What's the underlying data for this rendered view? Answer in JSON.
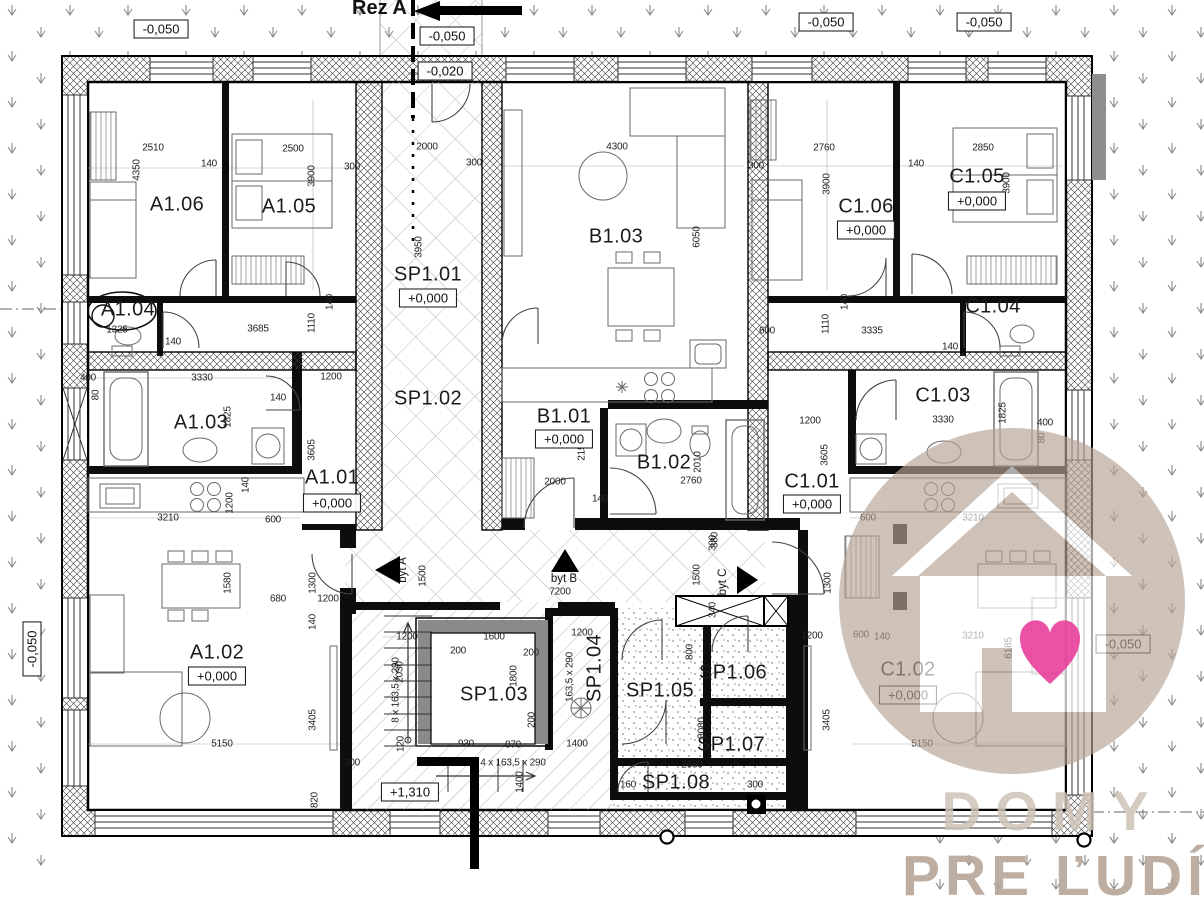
{
  "section_marker": {
    "label": "Rez A"
  },
  "apartments": [
    {
      "label": "byt A",
      "x": 403,
      "y": 570,
      "r": 1
    },
    {
      "label": "byt B",
      "x": 564,
      "y": 579,
      "r": 0
    },
    {
      "label": "byt C",
      "x": 723,
      "y": 582,
      "r": 1
    }
  ],
  "rooms": [
    {
      "label": "A1.06",
      "x": 177,
      "y": 205
    },
    {
      "label": "A1.05",
      "x": 289,
      "y": 207
    },
    {
      "label": "A1.04",
      "x": 128,
      "y": 310
    },
    {
      "label": "A1.03",
      "x": 201,
      "y": 423
    },
    {
      "label": "A1.01",
      "x": 332,
      "y": 478,
      "elev": "+0,000",
      "ey": 503
    },
    {
      "label": "A1.02",
      "x": 217,
      "y": 653,
      "elev": "+0,000",
      "ey": 676
    },
    {
      "label": "SP1.01",
      "x": 428,
      "y": 275,
      "elev": "+0,000",
      "ey": 298
    },
    {
      "label": "SP1.02",
      "x": 428,
      "y": 399
    },
    {
      "label": "B1.03",
      "x": 616,
      "y": 237
    },
    {
      "label": "B1.01",
      "x": 564,
      "y": 417,
      "elev": "+0,000",
      "ey": 439
    },
    {
      "label": "B1.02",
      "x": 664,
      "y": 463
    },
    {
      "label": "C1.06",
      "x": 866,
      "y": 207,
      "elev": "+0,000",
      "ey": 230
    },
    {
      "label": "C1.05",
      "x": 977,
      "y": 177,
      "elev": "+0,000",
      "ey": 201
    },
    {
      "label": "C1.04",
      "x": 993,
      "y": 307
    },
    {
      "label": "C1.03",
      "x": 943,
      "y": 396
    },
    {
      "label": "C1.01",
      "x": 812,
      "y": 482,
      "elev": "+0,000",
      "ey": 504
    },
    {
      "label": "C1.02",
      "x": 908,
      "y": 670,
      "elev": "+0,000",
      "ey": 695
    },
    {
      "label": "SP1.03",
      "x": 494,
      "y": 695
    },
    {
      "label": "SP1.04",
      "x": 595,
      "y": 668,
      "r": 1
    },
    {
      "label": "SP1.05",
      "x": 660,
      "y": 691
    },
    {
      "label": "SP1.06",
      "x": 733,
      "y": 673
    },
    {
      "label": "SP1.07",
      "x": 731,
      "y": 745
    },
    {
      "label": "SP1.08",
      "x": 676,
      "y": 783
    }
  ],
  "elevation_markers": [
    {
      "t": "-0,050",
      "x": 161,
      "y": 29
    },
    {
      "t": "-0,050",
      "x": 447,
      "y": 36
    },
    {
      "t": "-0,020",
      "x": 445,
      "y": 71
    },
    {
      "t": "-0,050",
      "x": 826,
      "y": 22
    },
    {
      "t": "-0,050",
      "x": 984,
      "y": 22
    },
    {
      "t": "-0,050",
      "x": 1123,
      "y": 644
    },
    {
      "t": "-0,050",
      "x": 32,
      "y": 649,
      "r": 1
    },
    {
      "t": "+1,310",
      "x": 410,
      "y": 792
    }
  ],
  "dimensions": [
    {
      "t": "2510",
      "x": 153,
      "y": 148
    },
    {
      "t": "4350",
      "x": 137,
      "y": 170,
      "r": 1
    },
    {
      "t": "140",
      "x": 209,
      "y": 164
    },
    {
      "t": "2500",
      "x": 293,
      "y": 149
    },
    {
      "t": "3900",
      "x": 312,
      "y": 176,
      "r": 1
    },
    {
      "t": "300",
      "x": 352,
      "y": 167
    },
    {
      "t": "2000",
      "x": 427,
      "y": 147
    },
    {
      "t": "300",
      "x": 474,
      "y": 163
    },
    {
      "t": "3950",
      "x": 419,
      "y": 247,
      "r": 1
    },
    {
      "t": "4300",
      "x": 617,
      "y": 147
    },
    {
      "t": "6050",
      "x": 697,
      "y": 237,
      "r": 1
    },
    {
      "t": "300",
      "x": 756,
      "y": 166
    },
    {
      "t": "2760",
      "x": 824,
      "y": 148
    },
    {
      "t": "3900",
      "x": 827,
      "y": 184,
      "r": 1
    },
    {
      "t": "140",
      "x": 916,
      "y": 164
    },
    {
      "t": "2850",
      "x": 983,
      "y": 148
    },
    {
      "t": "3900",
      "x": 1007,
      "y": 183,
      "r": 1
    },
    {
      "t": "1325",
      "x": 117,
      "y": 330
    },
    {
      "t": "140",
      "x": 173,
      "y": 342
    },
    {
      "t": "3685",
      "x": 258,
      "y": 329
    },
    {
      "t": "1110",
      "x": 312,
      "y": 323,
      "r": 1
    },
    {
      "t": "140",
      "x": 330,
      "y": 302,
      "r": 1
    },
    {
      "t": "400",
      "x": 88,
      "y": 378
    },
    {
      "t": "80",
      "x": 96,
      "y": 395,
      "r": 1
    },
    {
      "t": "3330",
      "x": 202,
      "y": 378
    },
    {
      "t": "1200",
      "x": 331,
      "y": 377
    },
    {
      "t": "1825",
      "x": 228,
      "y": 417,
      "r": 1
    },
    {
      "t": "140",
      "x": 278,
      "y": 398
    },
    {
      "t": "3605",
      "x": 312,
      "y": 450,
      "r": 1
    },
    {
      "t": "1200",
      "x": 230,
      "y": 503,
      "r": 1
    },
    {
      "t": "140",
      "x": 246,
      "y": 485,
      "r": 1
    },
    {
      "t": "3210",
      "x": 168,
      "y": 518
    },
    {
      "t": "600",
      "x": 273,
      "y": 520
    },
    {
      "t": "1580",
      "x": 228,
      "y": 583,
      "r": 1
    },
    {
      "t": "680",
      "x": 278,
      "y": 599
    },
    {
      "t": "1300",
      "x": 313,
      "y": 583,
      "r": 1
    },
    {
      "t": "1200",
      "x": 328,
      "y": 599
    },
    {
      "t": "140",
      "x": 313,
      "y": 622,
      "r": 1
    },
    {
      "t": "3405",
      "x": 313,
      "y": 720,
      "r": 1
    },
    {
      "t": "5150",
      "x": 222,
      "y": 744
    },
    {
      "t": "300",
      "x": 352,
      "y": 763
    },
    {
      "t": "820",
      "x": 315,
      "y": 800,
      "r": 1
    },
    {
      "t": "2150",
      "x": 582,
      "y": 450,
      "r": 1
    },
    {
      "t": "2000",
      "x": 555,
      "y": 482
    },
    {
      "t": "140",
      "x": 600,
      "y": 499
    },
    {
      "t": "2760",
      "x": 691,
      "y": 481
    },
    {
      "t": "2010",
      "x": 698,
      "y": 462,
      "r": 1
    },
    {
      "t": "1200",
      "x": 810,
      "y": 421
    },
    {
      "t": "380",
      "x": 715,
      "y": 540,
      "r": 1
    },
    {
      "t": "1500",
      "x": 697,
      "y": 575,
      "r": 1
    },
    {
      "t": "300",
      "x": 713,
      "y": 543,
      "r": 1
    },
    {
      "t": "7200",
      "x": 560,
      "y": 592
    },
    {
      "t": "1500",
      "x": 423,
      "y": 576,
      "r": 1
    },
    {
      "t": "340",
      "x": 713,
      "y": 610,
      "r": 1
    },
    {
      "t": "600",
      "x": 767,
      "y": 331
    },
    {
      "t": "3335",
      "x": 872,
      "y": 331
    },
    {
      "t": "1110",
      "x": 826,
      "y": 324,
      "r": 1
    },
    {
      "t": "140",
      "x": 845,
      "y": 302,
      "r": 1
    },
    {
      "t": "140",
      "x": 950,
      "y": 347
    },
    {
      "t": "3605",
      "x": 825,
      "y": 455,
      "r": 1
    },
    {
      "t": "3330",
      "x": 943,
      "y": 420
    },
    {
      "t": "1825",
      "x": 1003,
      "y": 413,
      "r": 1
    },
    {
      "t": "400",
      "x": 1045,
      "y": 423
    },
    {
      "t": "80",
      "x": 1042,
      "y": 438,
      "r": 1
    },
    {
      "t": "600",
      "x": 868,
      "y": 518
    },
    {
      "t": "3210",
      "x": 973,
      "y": 518
    },
    {
      "t": "1200",
      "x": 812,
      "y": 636
    },
    {
      "t": "600",
      "x": 861,
      "y": 635
    },
    {
      "t": "140",
      "x": 882,
      "y": 637
    },
    {
      "t": "3210",
      "x": 973,
      "y": 636
    },
    {
      "t": "6185",
      "x": 1009,
      "y": 648,
      "r": 1
    },
    {
      "t": "1300",
      "x": 828,
      "y": 583,
      "r": 1
    },
    {
      "t": "3405",
      "x": 827,
      "y": 720,
      "r": 1
    },
    {
      "t": "5150",
      "x": 922,
      "y": 744
    },
    {
      "t": "1200",
      "x": 407,
      "y": 637
    },
    {
      "t": "2030",
      "x": 400,
      "y": 672,
      "r": 1
    },
    {
      "t": "8 x 163,5 x 290",
      "x": 396,
      "y": 690,
      "r": 1
    },
    {
      "t": "200",
      "x": 458,
      "y": 651
    },
    {
      "t": "120",
      "x": 401,
      "y": 744,
      "r": 1
    },
    {
      "t": "930",
      "x": 466,
      "y": 744
    },
    {
      "t": "1600",
      "x": 494,
      "y": 637
    },
    {
      "t": "200",
      "x": 531,
      "y": 653
    },
    {
      "t": "1800",
      "x": 514,
      "y": 676,
      "r": 1
    },
    {
      "t": "200",
      "x": 532,
      "y": 720,
      "r": 1
    },
    {
      "t": "870",
      "x": 513,
      "y": 745
    },
    {
      "t": "1400",
      "x": 577,
      "y": 744
    },
    {
      "t": "4 x 163,5 x 290",
      "x": 513,
      "y": 763
    },
    {
      "t": "1400",
      "x": 520,
      "y": 782,
      "r": 1
    },
    {
      "t": "1200",
      "x": 582,
      "y": 633
    },
    {
      "t": "163,5 x 290",
      "x": 570,
      "y": 677,
      "r": 1
    },
    {
      "t": "2660",
      "x": 692,
      "y": 765
    },
    {
      "t": "160",
      "x": 628,
      "y": 785
    },
    {
      "t": "300",
      "x": 755,
      "y": 785
    },
    {
      "t": "3080",
      "x": 702,
      "y": 728,
      "r": 1
    },
    {
      "t": "800",
      "x": 690,
      "y": 652,
      "r": 1
    }
  ],
  "watermark": {
    "line1": "DOMY",
    "line2": "PRE ĽUDÍ",
    "circle_color": "#b5a294",
    "house_color": "#ffffff",
    "heart_color": "#e83a98",
    "line1_color": "#cdc2b7",
    "line2_color": "#b7a699"
  },
  "colors": {
    "paper": "#ffffff",
    "ink": "#111111",
    "pattern_gray": "#b0b0b0",
    "terrain_arrow": "#8a8a8a",
    "shaft_gray": "#8a8a8a"
  }
}
